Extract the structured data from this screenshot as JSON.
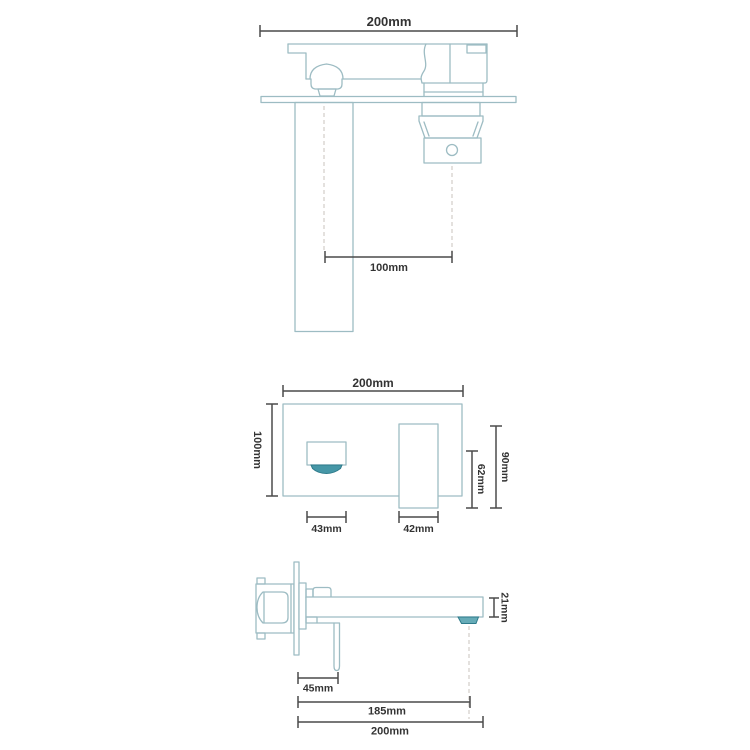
{
  "colors": {
    "background": "#ffffff",
    "outline": "#9dbcc3",
    "dimension": "#4a4a4a",
    "label": "#333333",
    "centerline": "#d2cdc8",
    "outlet_fill": "#4697a7",
    "outlet_stroke": "#2e7b8b",
    "outlet_side_fill": "#66abb7"
  },
  "views": {
    "plan": {
      "dims": {
        "overall_width": "200mm",
        "spout_to_valve": "100mm"
      }
    },
    "front": {
      "dims": {
        "plate_width": "200mm",
        "plate_height": "100mm",
        "spout_width": "43mm",
        "handle_width": "42mm",
        "handle_drop": "62mm",
        "handle_height": "90mm"
      }
    },
    "side": {
      "dims": {
        "spout_height": "21mm",
        "handle_offset": "45mm",
        "spout_reach": "185mm",
        "overall_reach": "200mm"
      }
    }
  }
}
